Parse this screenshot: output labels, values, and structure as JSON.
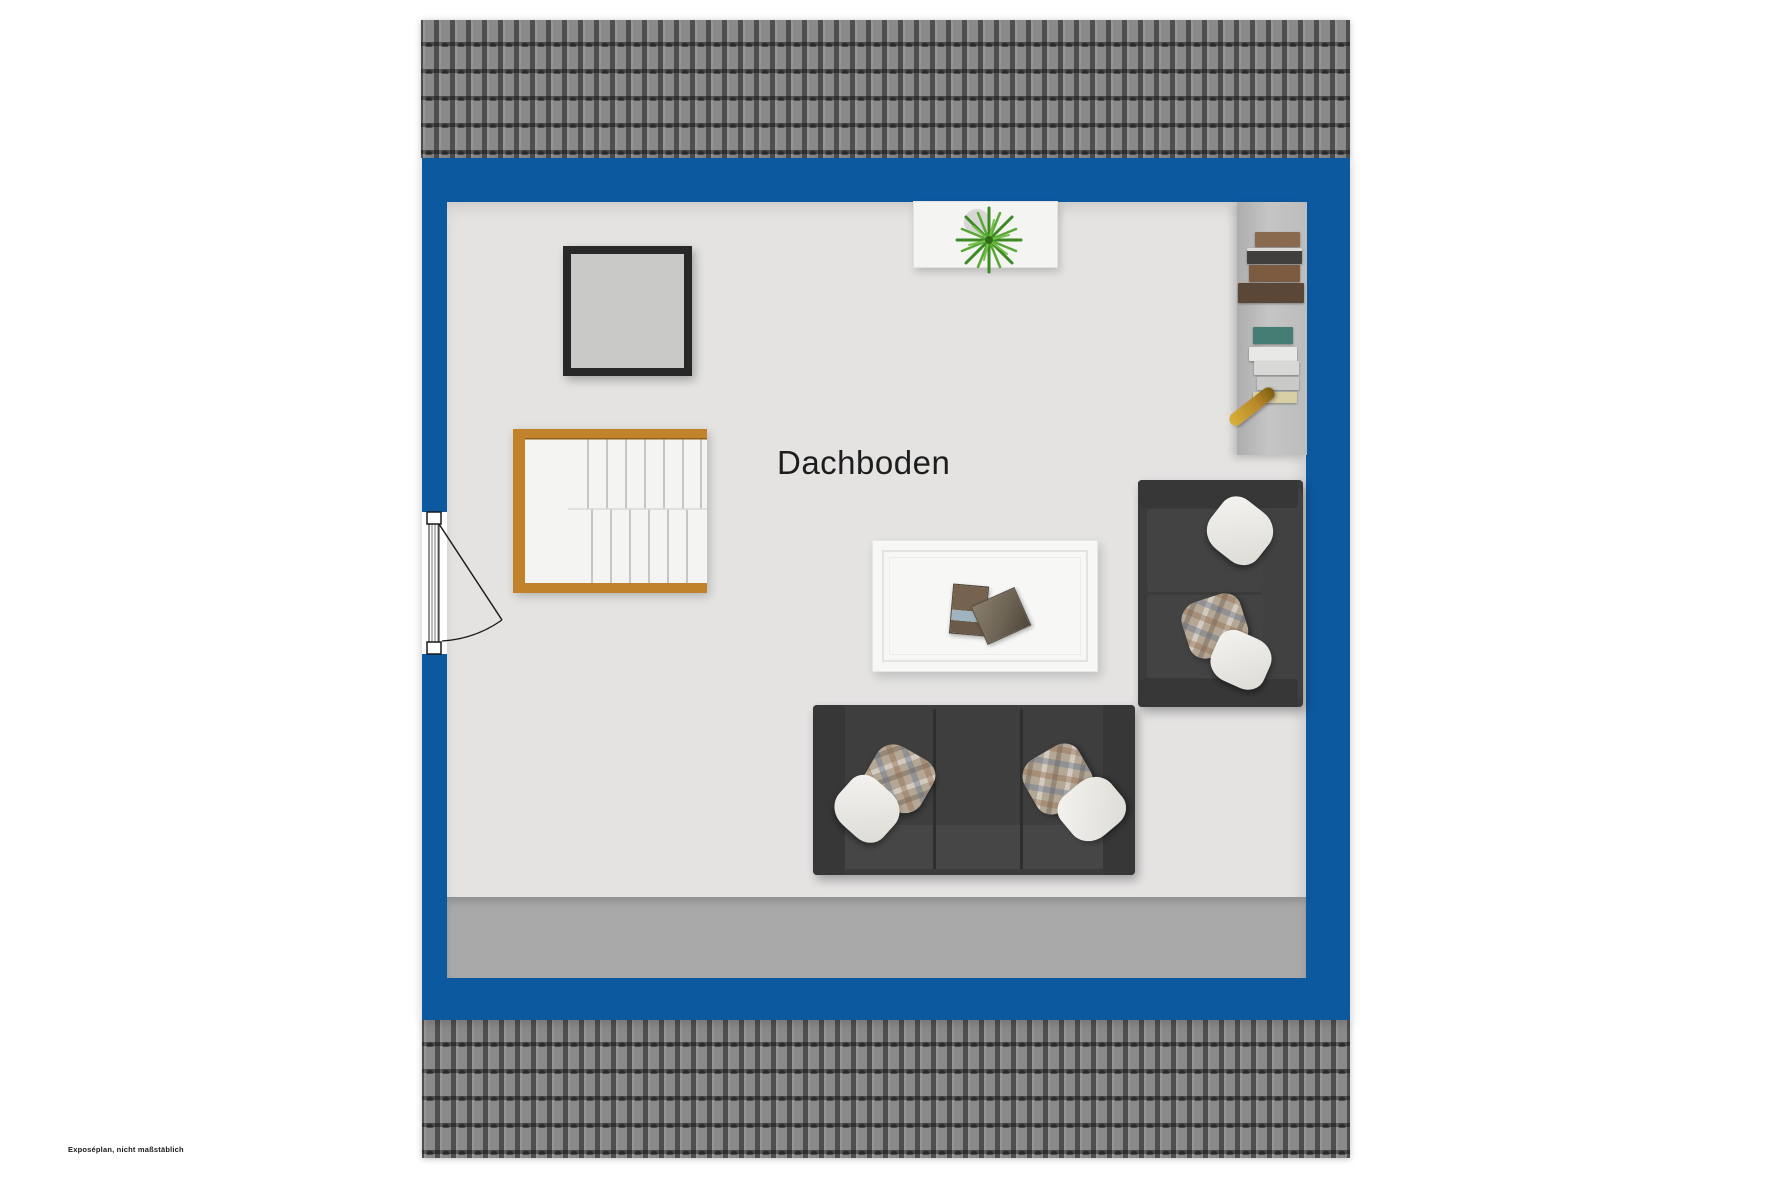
{
  "floor_plan": {
    "room_label": "Dachboden",
    "disclaimer": "Exposéplan, nicht maßstäblich",
    "furniture": [
      "staircase",
      "entry-door-with-swing",
      "picture-frame",
      "sideboard-with-plant",
      "bookshelf",
      "coffee-table-with-magazines",
      "two-seat-sofa",
      "three-seat-sofa"
    ],
    "colors": {
      "wall_blue": "#0d59a0",
      "roof_tile_gray": "#8a8a8a",
      "floor_gray": "#e4e3e2",
      "lower_band_gray": "#a9a8a8",
      "stair_wood": "#c0832c",
      "sofa_dark": "#3b3b3b",
      "picture_frame": "#282828",
      "plant_green": "#4e9427"
    }
  }
}
